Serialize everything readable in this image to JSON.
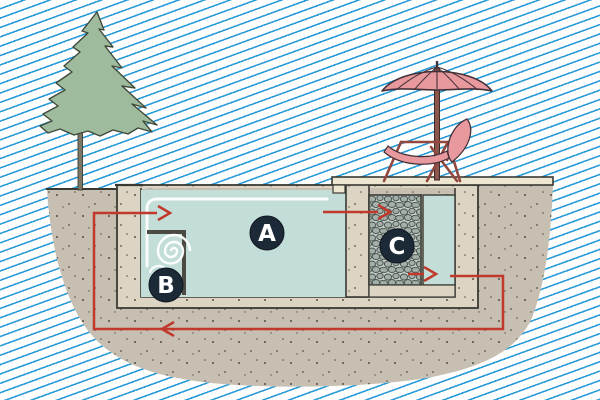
{
  "labels": {
    "a": "A",
    "b": "B",
    "c": "C"
  },
  "colors": {
    "stripe": "#2B9CD8",
    "ground": "#C7BFB1",
    "shell": "#DCD5C4",
    "water": "#C3DDD9",
    "gravel_bg": "#C6CCC6",
    "pebble": "#A3B0AA",
    "deck": "#EDE6D0",
    "foliage": "#9FBB9D",
    "trunk": "#7C7868",
    "umbrella_pink": "#E8999E",
    "chair_frame": "#93473F",
    "pole": "#8A564E",
    "flow_red": "#C0392B",
    "label_bg": "#1C2937",
    "label_text": "#FFFFFF",
    "surface_line": "#FFFFFF",
    "skimmer_gray": "#4B4B44"
  }
}
